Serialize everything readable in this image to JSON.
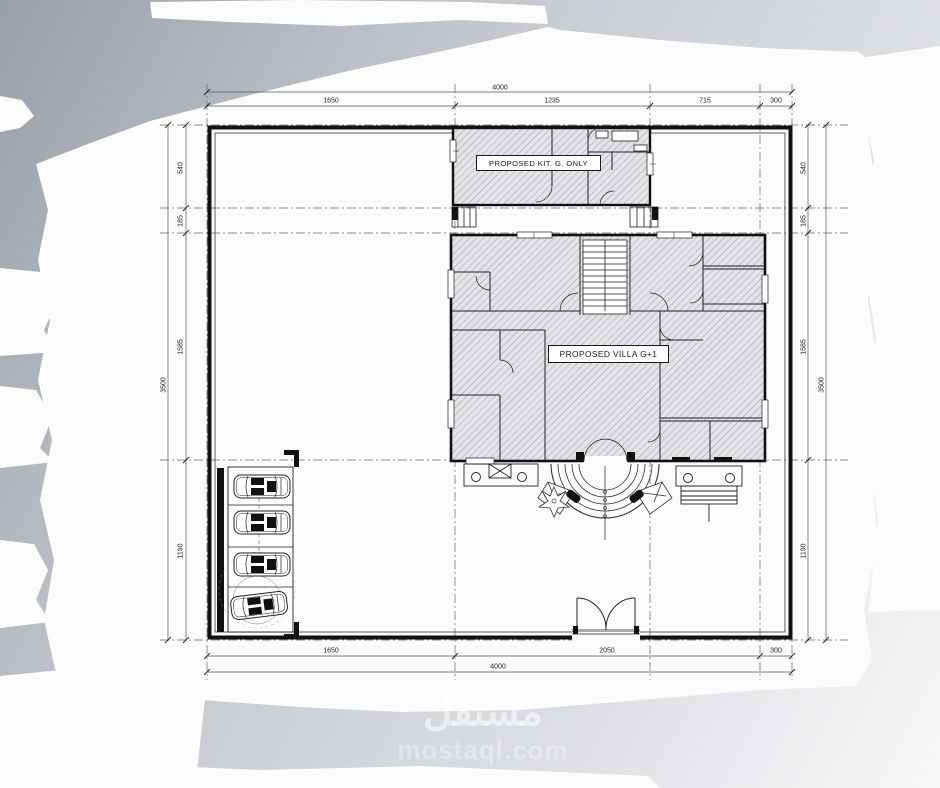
{
  "drawing": {
    "labels": {
      "kitchen": "PROPOSED KIT. G. ONLY",
      "villa": "PROPOSED VILLA G+1"
    },
    "dimensions": {
      "top": {
        "overall": "4000",
        "segments": [
          "1650",
          "1235",
          "715",
          "300"
        ]
      },
      "bottom": {
        "overall": "4000",
        "segments": [
          "1650",
          "2050",
          "300"
        ]
      },
      "left": {
        "overall": "3500",
        "segments": [
          "540",
          "185",
          "1585",
          "1190"
        ]
      },
      "right": {
        "overall": "3500",
        "segments": [
          "540",
          "185",
          "1585",
          "1190"
        ]
      }
    }
  },
  "watermark": {
    "arabic": "مستقل",
    "latin": "mostaql.com"
  },
  "colors": {
    "paper": "#fcfcfd",
    "background_gray": "#c9cdd2",
    "line": "#1a1a1a",
    "hatch": "#9aa0a7"
  }
}
